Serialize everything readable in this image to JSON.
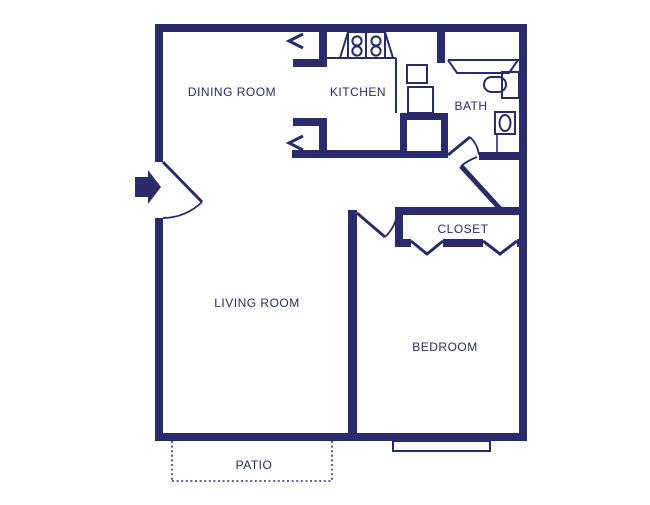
{
  "palette": {
    "wall_color": "#2b2a6b",
    "background": "#ffffff"
  },
  "rooms": {
    "dining_room": "DINING ROOM",
    "kitchen": "KITCHEN",
    "bath": "BATH",
    "closet": "CLOSET",
    "living_room": "LIVING ROOM",
    "bedroom": "BEDROOM",
    "patio": "PATIO"
  },
  "fixtures": {
    "stove_burners": "4-circle cooktop",
    "kitchen_sink": "thin rectangle",
    "counter_appliance": "thin rectangle",
    "pantry_closet": "thick-wall box",
    "bathtub": "trapezoid band",
    "vanity_sink": "rect with stadium basin",
    "toilet": "rect with ellipse",
    "entry_arrow": "solid right arrow",
    "entry_door": "swing arc",
    "bath_door": "swing arc",
    "hall_door": "swing arc",
    "bedroom_door": "swing arc",
    "closet_bifold_doors": "v-chevrons",
    "opening_markers": "left chevrons",
    "bedroom_window": "thin rect on wall",
    "patio_boundary": "dashed rect"
  }
}
